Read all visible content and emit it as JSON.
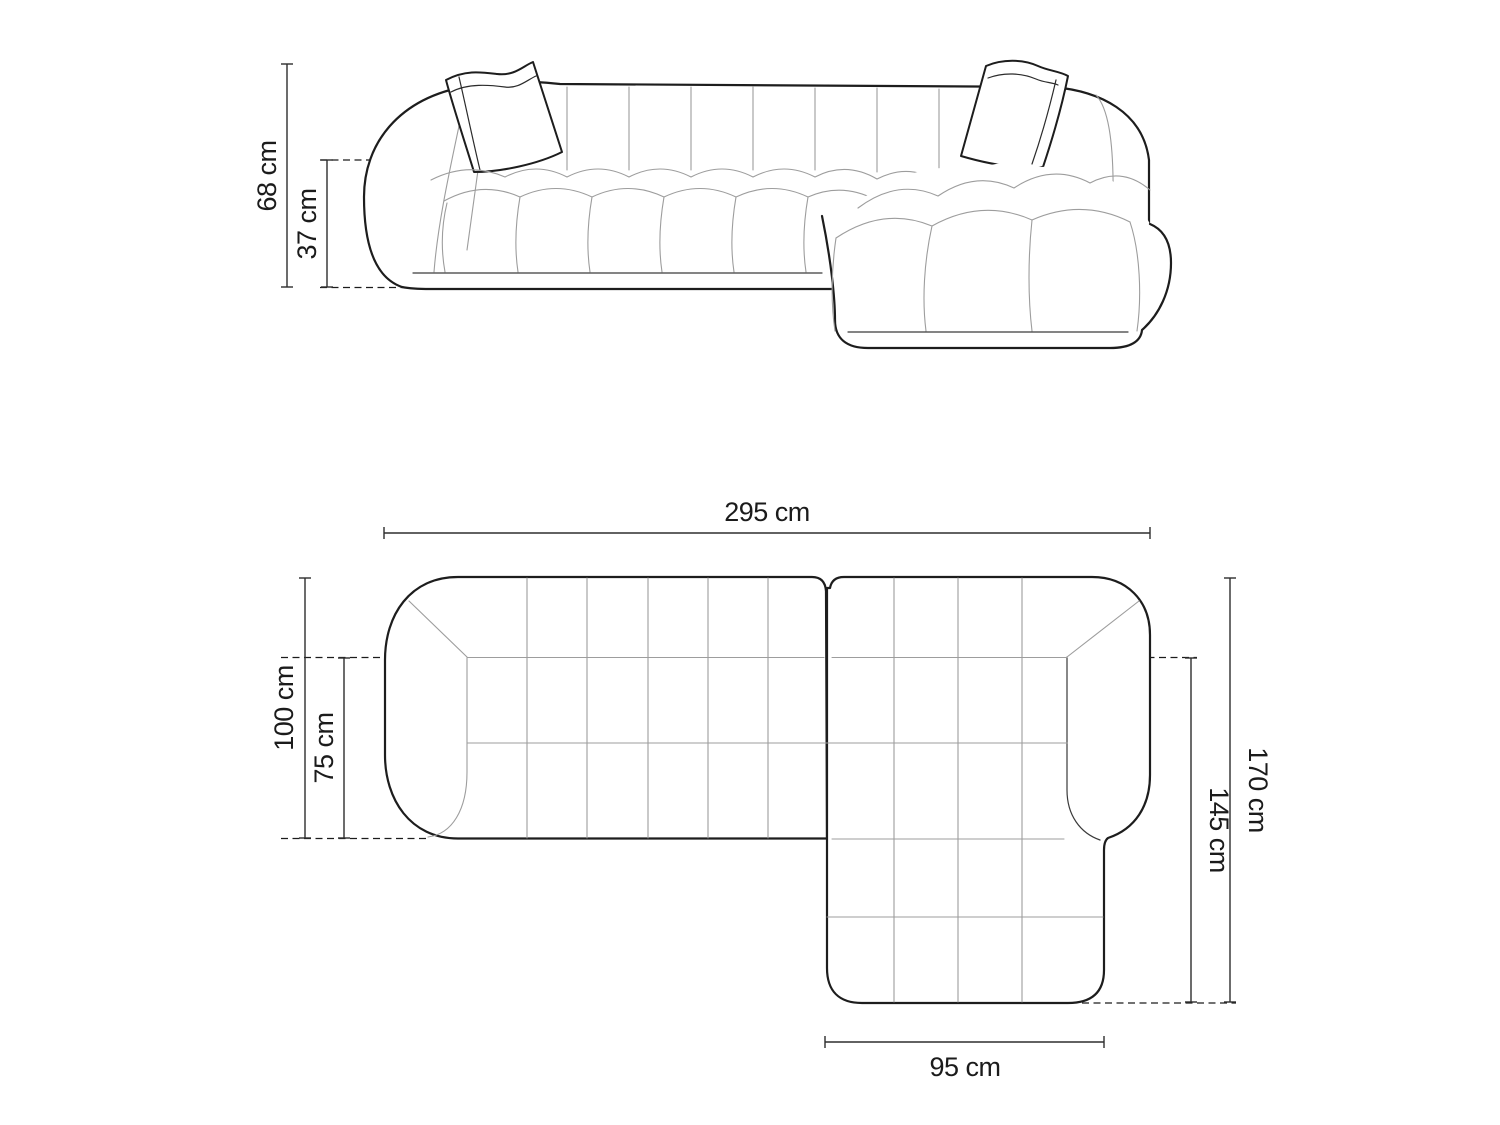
{
  "drawing_title": "Corner sofa technical drawing",
  "colors": {
    "background": "#ffffff",
    "outline": "#1d1d1d",
    "seam": "#9d9d9d",
    "dimension": "#2e2e2e",
    "label_text": "#1b1b1b"
  },
  "elevation": {
    "overall_height": "68 cm",
    "seat_height": "37 cm"
  },
  "plan": {
    "overall_width": "295 cm",
    "overall_depth": "100 cm",
    "seat_depth": "75 cm",
    "total_length": "170 cm",
    "inner_length": "145 cm",
    "chaise_width": "95 cm"
  }
}
